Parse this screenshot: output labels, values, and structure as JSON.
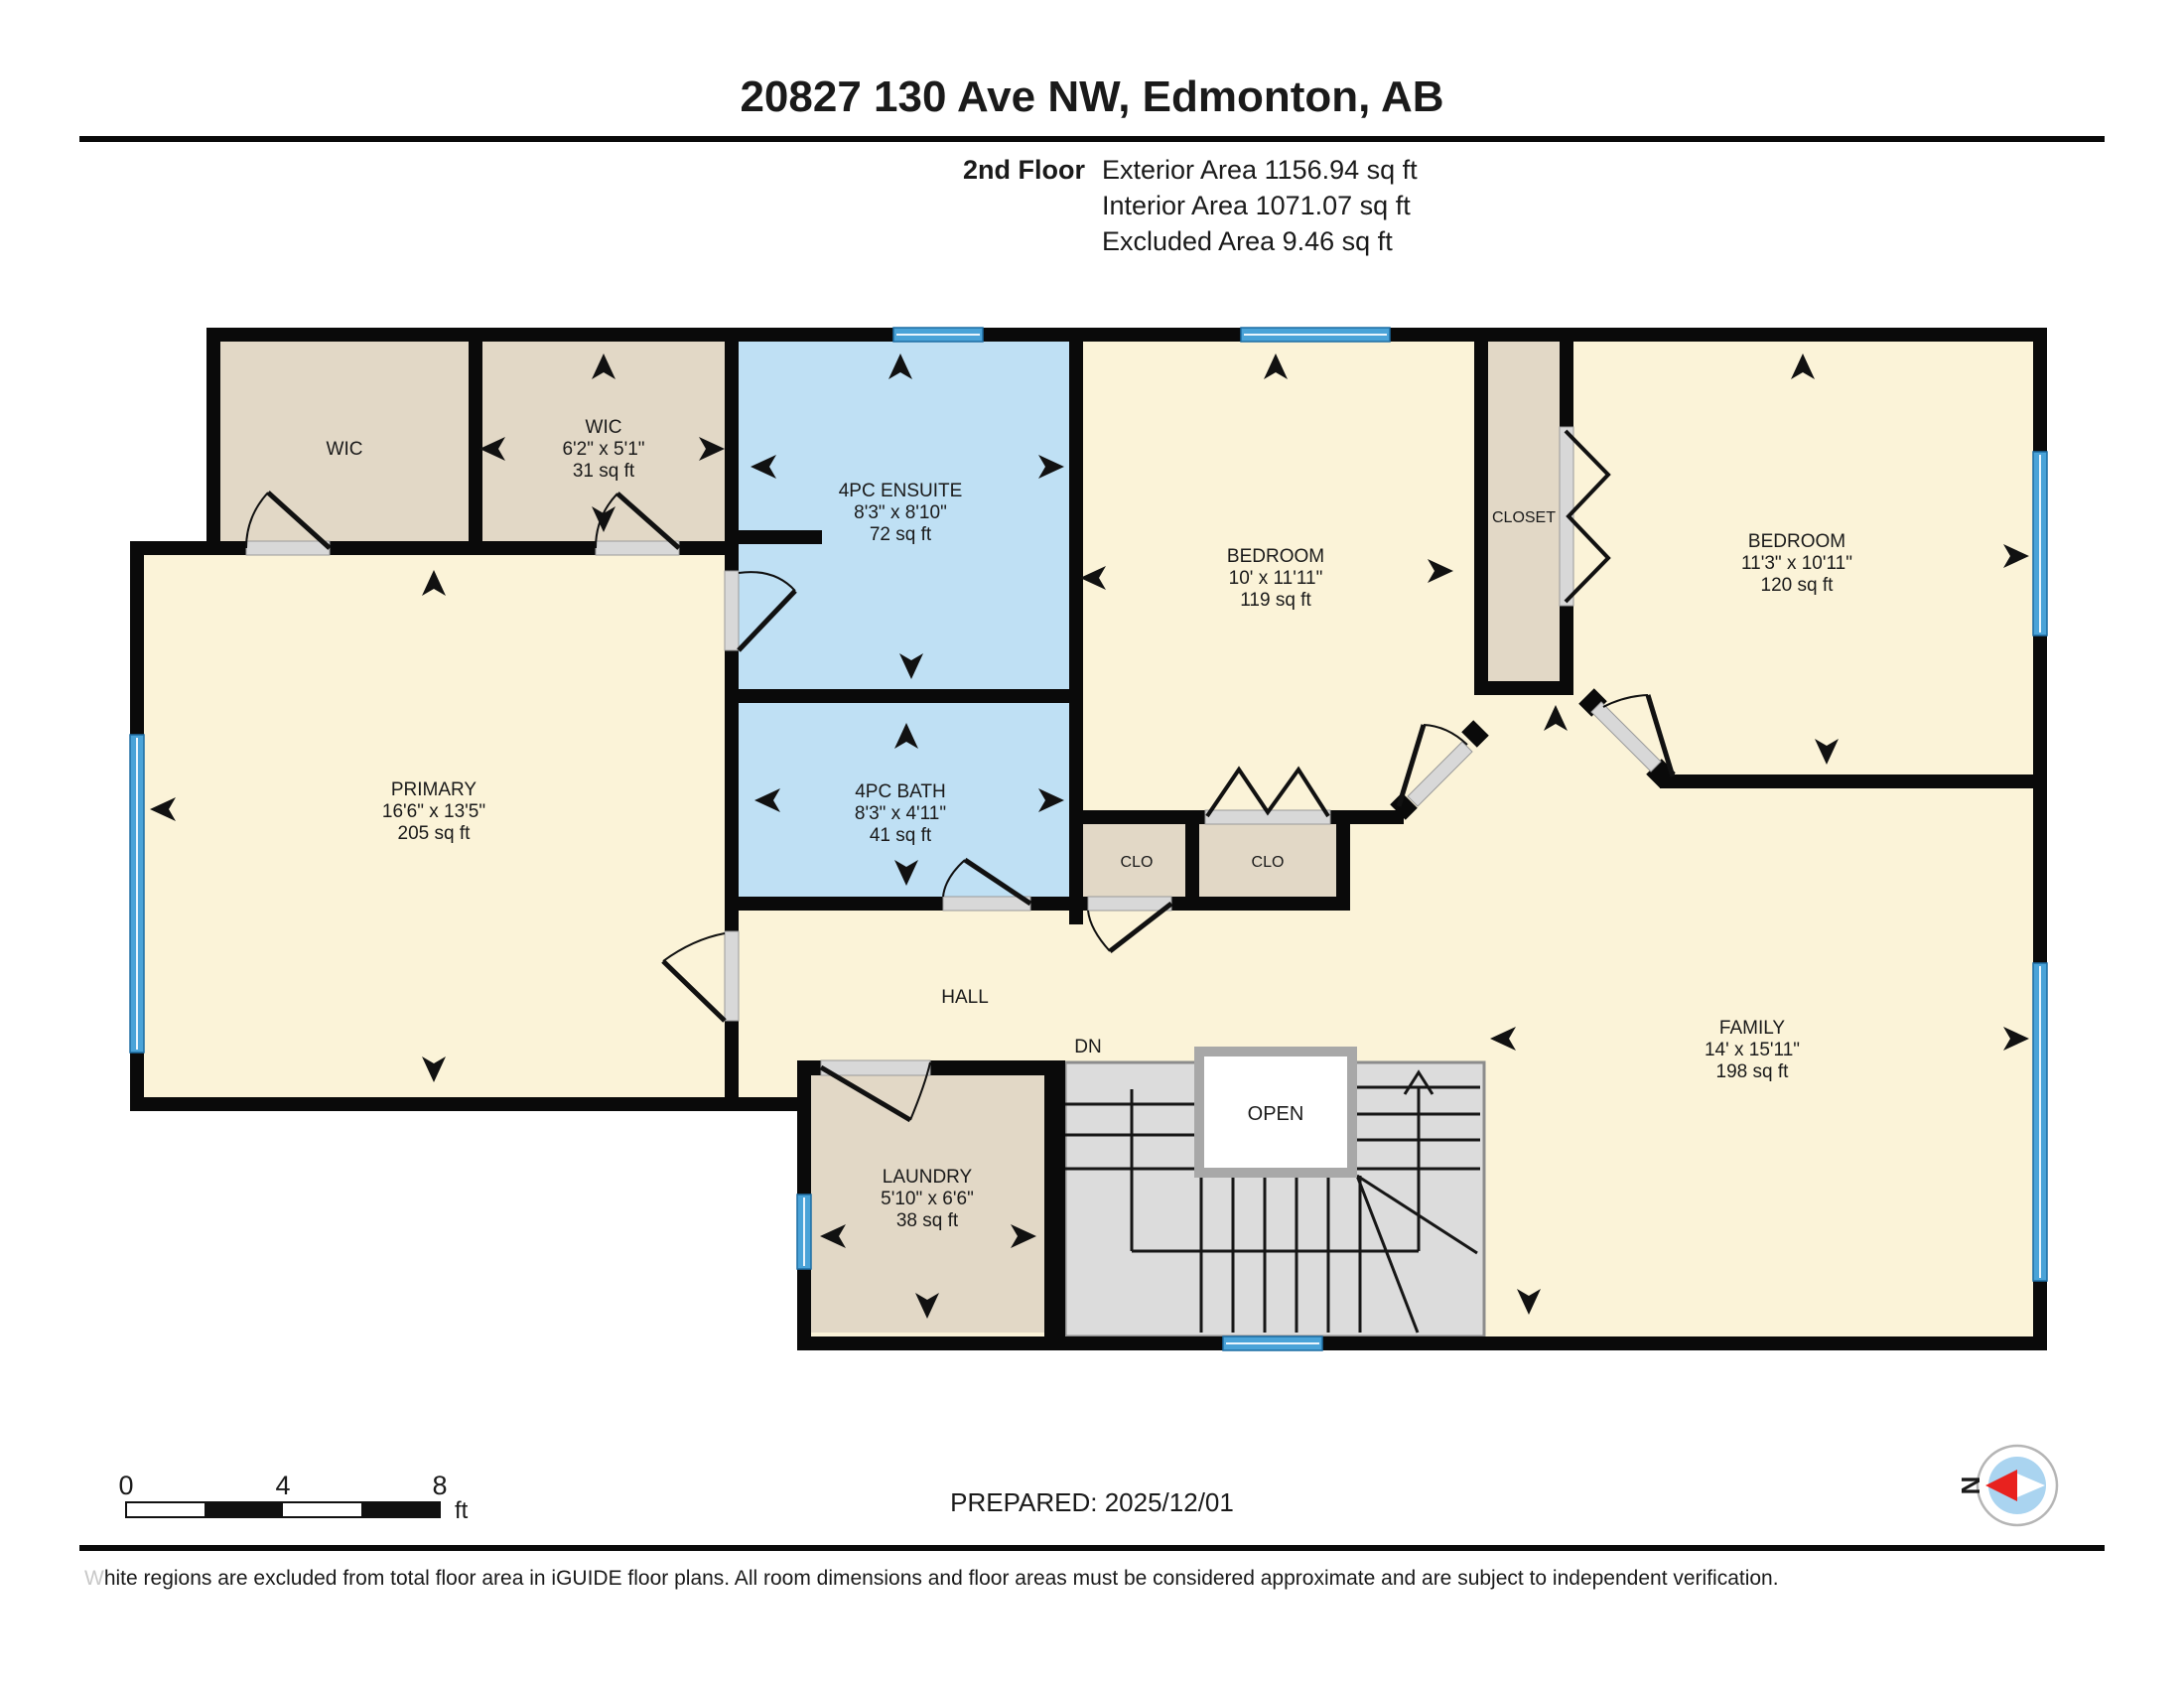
{
  "header": {
    "title": "20827 130 Ave NW, Edmonton, AB",
    "floor_label": "2nd Floor",
    "area_lines": [
      "Exterior Area 1156.94 sq ft",
      "Interior Area 1071.07 sq ft",
      "Excluded Area 9.46 sq ft"
    ]
  },
  "rooms": {
    "wic1": {
      "name": "WIC"
    },
    "wic2": {
      "name": "WIC",
      "dims": "6'2\" x 5'1\"",
      "area": "31 sq ft"
    },
    "ensuite": {
      "name": "4PC ENSUITE",
      "dims": "8'3\" x 8'10\"",
      "area": "72 sq ft"
    },
    "bedroom1": {
      "name": "BEDROOM",
      "dims": "10' x 11'11\"",
      "area": "119 sq ft"
    },
    "closet": {
      "name": "CLOSET"
    },
    "bedroom2": {
      "name": "BEDROOM",
      "dims": "11'3\" x 10'11\"",
      "area": "120 sq ft"
    },
    "primary": {
      "name": "PRIMARY",
      "dims": "16'6\" x 13'5\"",
      "area": "205 sq ft"
    },
    "bath": {
      "name": "4PC BATH",
      "dims": "8'3\" x 4'11\"",
      "area": "41 sq ft"
    },
    "clo1": {
      "name": "CLO"
    },
    "clo2": {
      "name": "CLO"
    },
    "hall": {
      "name": "HALL"
    },
    "family": {
      "name": "FAMILY",
      "dims": "14' x 15'11\"",
      "area": "198 sq ft"
    },
    "laundry": {
      "name": "LAUNDRY",
      "dims": "5'10\" x 6'6\"",
      "area": "38 sq ft"
    },
    "stairs": {
      "open_label": "OPEN",
      "down_label": "DN"
    }
  },
  "scale_bar": {
    "ticks": [
      "0",
      "4",
      "8"
    ],
    "unit": "ft"
  },
  "footer": {
    "prepared": "PREPARED: 2025/12/01",
    "disclaimer_first": "W",
    "disclaimer_rest": "hite regions are excluded from total floor area in iGUIDE floor plans. All room dimensions and floor areas must be considered approximate and are subject to independent verification."
  },
  "compass": {
    "north_label": "N"
  },
  "colors": {
    "floor_cream": "#FBF3D8",
    "floor_tan": "#E2D8C6",
    "floor_blue": "#BFE0F4",
    "stairs_gray": "#DCDCDC",
    "window_blue": "#4AA3D8",
    "wall_black": "#0A0A0A",
    "compass_red": "#E8221F"
  }
}
